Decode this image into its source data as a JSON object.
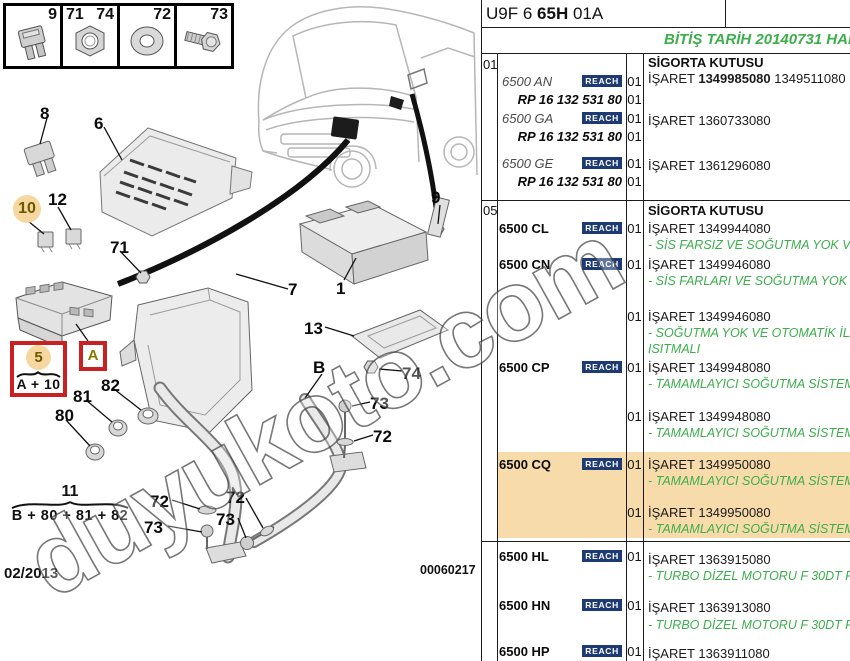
{
  "page": {
    "title_prefix": "U9F 6 ",
    "title_bold": "65H",
    "title_suffix": " 01A",
    "notice": "BİTİŞ TARİH 20140731 HARİ",
    "date": "02/2013",
    "doc_number": "00060217",
    "watermark": "duyukoto.com"
  },
  "legend": {
    "cells": [
      {
        "nums": [
          "9"
        ],
        "icon": "fuse-icon"
      },
      {
        "nums": [
          "71",
          "74"
        ],
        "icon": "nut-icon"
      },
      {
        "nums": [
          "72"
        ],
        "icon": "washer-icon"
      },
      {
        "nums": [
          "73"
        ],
        "icon": "bolt-icon"
      }
    ]
  },
  "diagram": {
    "callouts": [
      "8",
      "6",
      "10",
      "12",
      "71",
      "9",
      "1",
      "7",
      "13",
      "74",
      "B",
      "73",
      "72",
      "72",
      "73",
      "72",
      "73",
      "81",
      "82",
      "80"
    ],
    "group5": {
      "num": "5",
      "formula": "A + 10"
    },
    "group11": {
      "num": "11",
      "formula": "B + 80 + 81 + 82"
    },
    "ref_a": "A"
  },
  "table": {
    "sections": [
      {
        "num": "01",
        "title": "SİGORTA KUTUSU"
      },
      {
        "num": "05",
        "title": "SİGORTA KUTUSU"
      }
    ],
    "reach_label": "REACH",
    "entries": [
      {
        "id": "an",
        "code": "6500 AN",
        "reach": true,
        "qty": "01",
        "sub_code": "RP 16 132 531 80",
        "sub_qty": "01",
        "isaret_label": "İŞARET",
        "part_no": "1349985080",
        "part_no_bold": true,
        "part_no2": "1349511080"
      },
      {
        "id": "ga",
        "code": "6500 GA",
        "reach": true,
        "qty": "01",
        "sub_code": "RP 16 132 531 80",
        "sub_qty": "01",
        "isaret_label": "İŞARET",
        "part_no": "1360733080"
      },
      {
        "id": "ge",
        "code": "6500 GE",
        "reach": true,
        "qty": "01",
        "sub_code": "RP 16 132 531 80",
        "sub_qty": "01",
        "isaret_label": "İŞARET",
        "part_no": "1361296080"
      },
      {
        "id": "cl",
        "code": "6500 CL",
        "reach": true,
        "qty": "01",
        "isaret_label": "İŞARET",
        "part_no": "1349944080",
        "note": "- SİS FARSIZ VE SOĞUTMA YOK VE TA"
      },
      {
        "id": "cn",
        "code": "6500 CN",
        "reach": true,
        "qty": "01",
        "isaret_label": "İŞARET",
        "part_no": "1349946080",
        "note": "- SİS FARLARI VE SOĞUTMA YOK"
      },
      {
        "id": "x1",
        "qty": "01",
        "isaret_label": "İŞARET",
        "part_no": "1349946080",
        "note": "- SOĞUTMA YOK VE OTOMATİK İLAVE",
        "note2": "ISITMALI"
      },
      {
        "id": "cp",
        "code": "6500 CP",
        "reach": true,
        "qty": "01",
        "isaret_label": "İŞARET",
        "part_no": "1349948080",
        "note": "- TAMAMLAYICI SOĞUTMA SİSTEMİ YO"
      },
      {
        "id": "x2",
        "qty": "01",
        "isaret_label": "İŞARET",
        "part_no": "1349948080",
        "note": "- TAMAMLAYICI SOĞUTMA SİSTEMİ YO"
      },
      {
        "id": "cq",
        "code": "6500 CQ",
        "reach": true,
        "qty": "01",
        "isaret_label": "İŞARET",
        "part_no": "1349950080",
        "note": "- TAMAMLAYICI SOĞUTMA SİSTEMİ İL",
        "highlight": true
      },
      {
        "id": "x3",
        "qty": "01",
        "isaret_label": "İŞARET",
        "part_no": "1349950080",
        "note": "- TAMAMLAYICI SOĞUTMA SİSTEMLİ",
        "highlight": true
      },
      {
        "id": "hl",
        "code": "6500 HL",
        "reach": true,
        "qty": "01",
        "isaret_label": "İŞARET",
        "part_no": "1363915080",
        "note": "- TURBO DİZEL MOTORU F 30DT FAP"
      },
      {
        "id": "hn",
        "code": "6500 HN",
        "reach": true,
        "qty": "01",
        "isaret_label": "İŞARET",
        "part_no": "1363913080",
        "note": "- TURBO DİZEL MOTORU F 30DT FAP"
      },
      {
        "id": "hp",
        "code": "6500 HP",
        "reach": true,
        "qty": "01",
        "isaret_label": "İŞARET",
        "part_no": "1363911080"
      }
    ]
  },
  "colors": {
    "green": "#3cae4c",
    "highlight": "#f7dbaa",
    "reach_bg": "#1d3a75",
    "red_box": "#c92121",
    "callout_circle": "#f6d7a0"
  }
}
